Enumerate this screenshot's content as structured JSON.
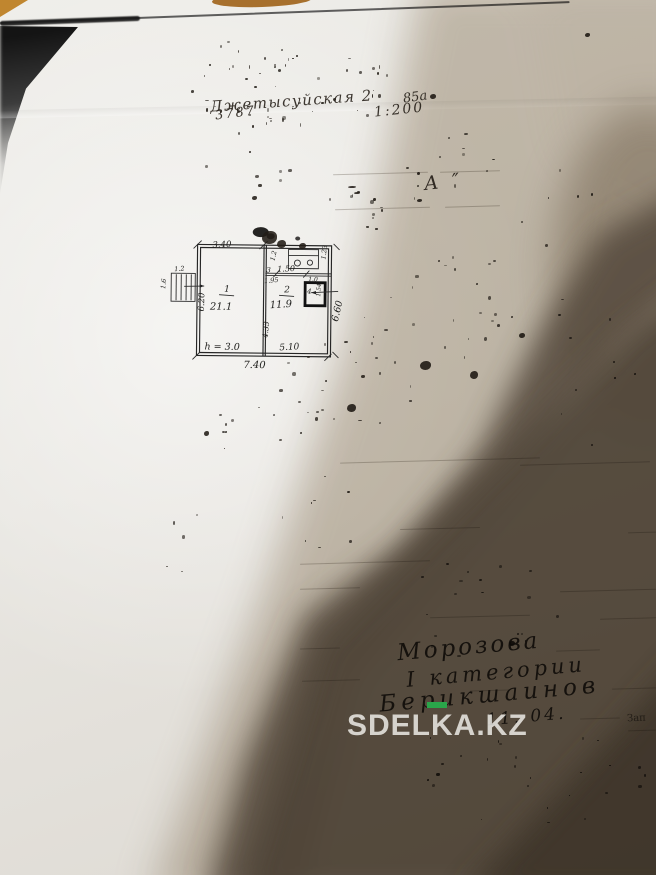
{
  "watermark": {
    "text": "SDELKA.KZ"
  },
  "header": {
    "street": "Джетысуйская 2",
    "number": "3787",
    "house": "85а",
    "scale": "1:200",
    "mark": "А ″"
  },
  "plan": {
    "room1": {
      "label": "1",
      "area": "21.1"
    },
    "room2": {
      "label": "2",
      "area": "11.9"
    },
    "room3": {
      "label": "3"
    },
    "room4": {
      "label": "4"
    },
    "dims": {
      "top": "3.40",
      "left": "6.20",
      "right": "6.60",
      "bottom": "7.40",
      "height": "h = 3.0",
      "r2w": "5.10",
      "r2h": "4.33",
      "r3w": "1.50",
      "r3h": "1.2",
      "r3r": "1.23",
      "n195": "1.95",
      "n10": "1.0",
      "n154": "1.54",
      "porch_top": "1.2",
      "porch_side": "1.6"
    }
  },
  "signatures": {
    "line1": "Морозова",
    "line2": "I категории",
    "line3": "Берикшаинов",
    "line4": "11. 04."
  },
  "misc": {
    "corner": "Зап"
  }
}
